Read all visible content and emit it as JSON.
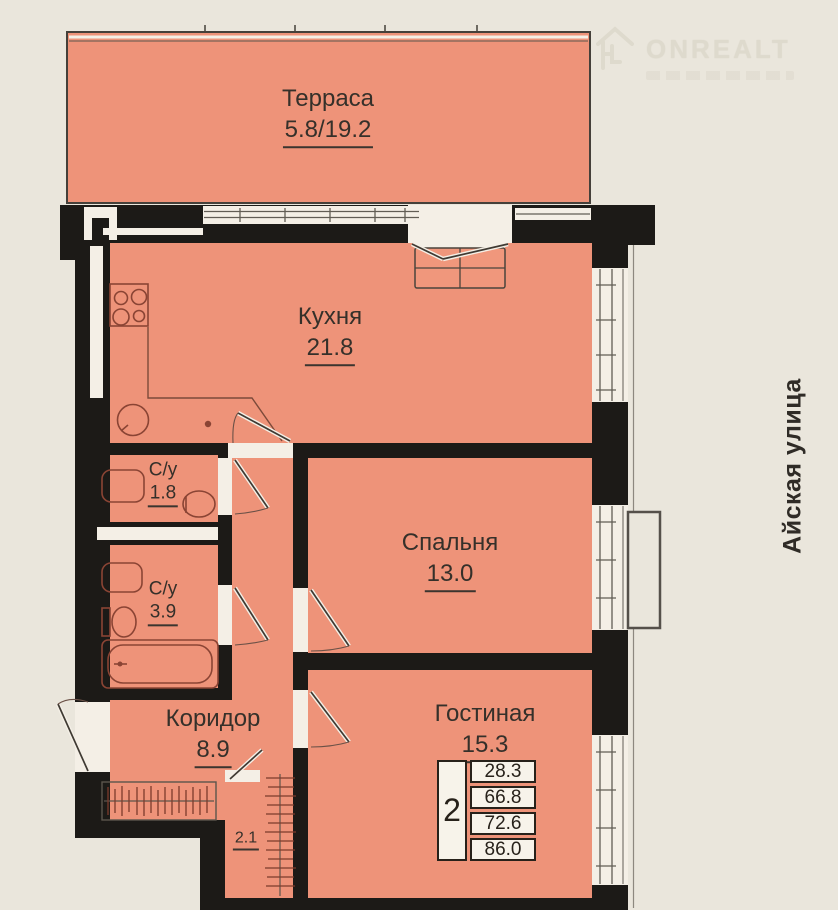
{
  "watermark": {
    "brand": "ONREALT",
    "icon": "house-arrow-icon"
  },
  "street_label": "Айская улица",
  "rooms": [
    {
      "name": "Терраса",
      "area": "5.8/19.2"
    },
    {
      "name": "Кухня",
      "area": "21.8"
    },
    {
      "name": "С/у",
      "area": "1.8"
    },
    {
      "name": "С/у",
      "area": "3.9"
    },
    {
      "name": "Спальня",
      "area": "13.0"
    },
    {
      "name": "Гостиная",
      "area": "15.3"
    },
    {
      "name": "Коридор",
      "area": "8.9"
    },
    {
      "name": "",
      "area": "2.1"
    }
  ],
  "summary_table": {
    "rooms_count": "2",
    "areas": [
      "28.3",
      "66.8",
      "72.6",
      "86.0"
    ]
  },
  "colors": {
    "background": "#eae6dc",
    "room_fill": "#ee9379",
    "wall": "#1c1a17",
    "opening_white": "#f4efe6",
    "fixture_line": "#8a4434",
    "text": "#35302a"
  }
}
